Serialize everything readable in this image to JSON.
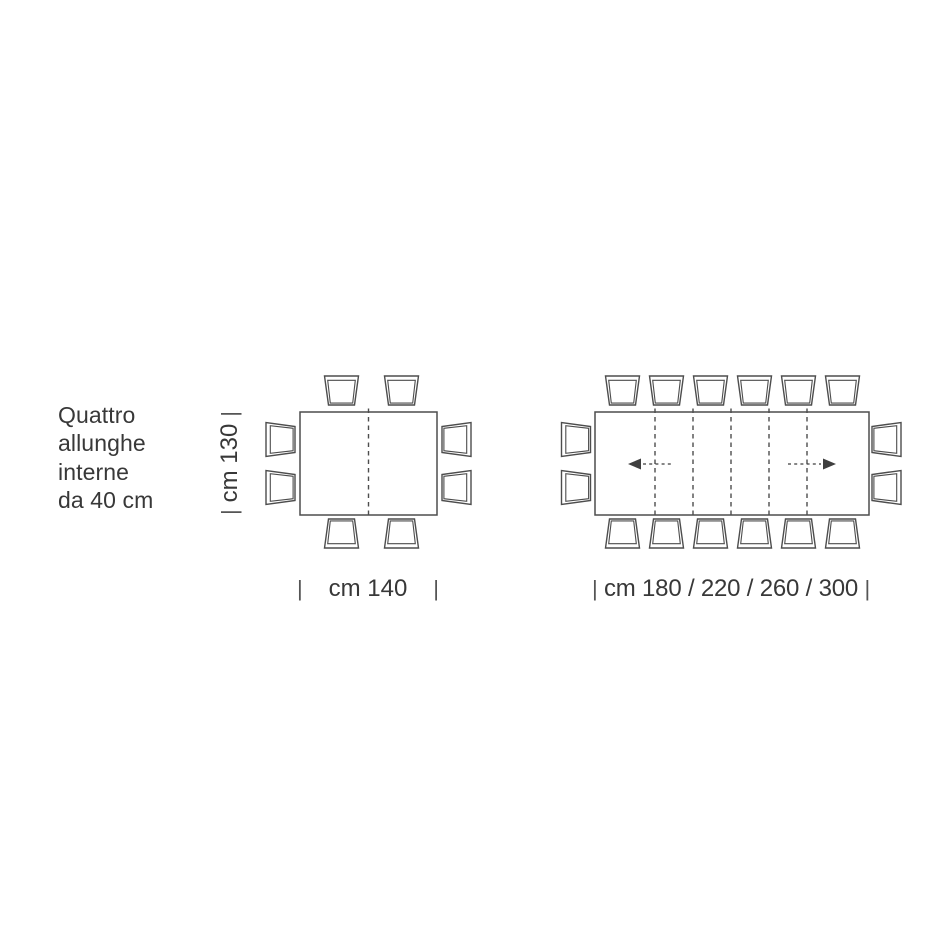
{
  "colors": {
    "background": "#ffffff",
    "line": "#4d4d4d",
    "text": "#383838",
    "arrow": "#3f3f3f"
  },
  "note": {
    "lines": [
      "Quattro",
      "allunghe",
      "interne",
      "da 40 cm"
    ]
  },
  "closed_table": {
    "depth_label": {
      "tick_left": "|",
      "text": "cm 130",
      "tick_right": "|"
    },
    "width_label": {
      "tick_left": "|",
      "text": "cm 140",
      "tick_right": "|"
    },
    "seats": 8,
    "extension_seams": 1
  },
  "extended_table": {
    "width_label": {
      "tick_left": "|",
      "text": "cm 180 / 220 / 260 / 300",
      "tick_right": "|"
    },
    "seats": 16,
    "extension_seams": 5,
    "extension_leaves": 4
  }
}
